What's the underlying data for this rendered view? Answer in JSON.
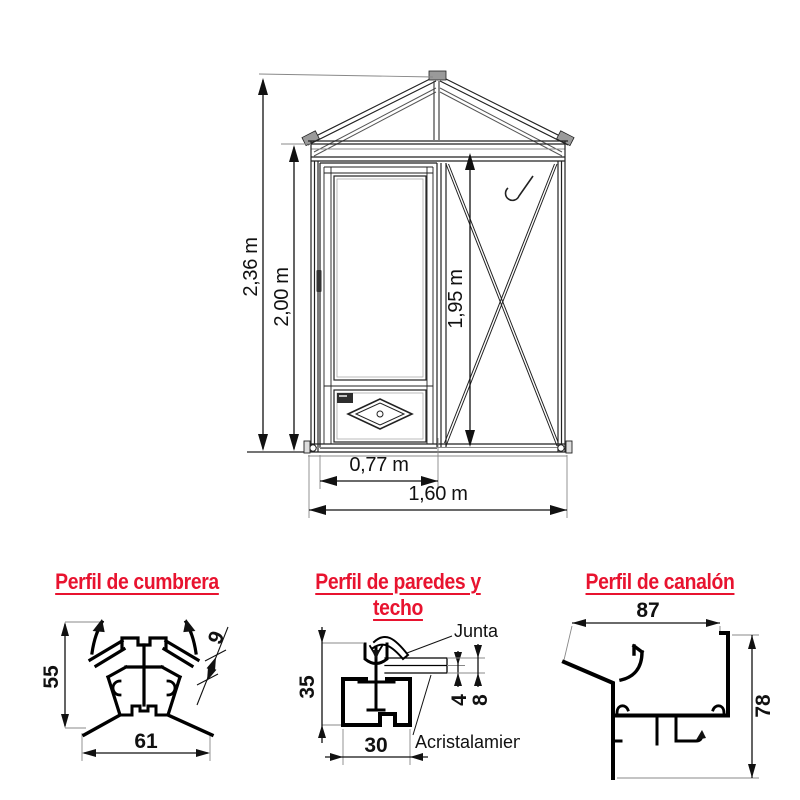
{
  "elevation": {
    "dim_total_height": "2,36 m",
    "dim_wall_height": "2,00 m",
    "dim_inner_height": "1,95 m",
    "dim_door_width": "0,77 m",
    "dim_total_width": "1,60 m"
  },
  "profiles": {
    "cumbrera": {
      "title": "Perfil de cumbrera",
      "dim_height": "55",
      "dim_width": "61",
      "dim_slot": "9"
    },
    "paredes": {
      "title": "Perfil de paredes y techo",
      "dim_height": "35",
      "dim_width": "30",
      "dim_glazing_single": "4",
      "dim_glazing_total": "8",
      "label_junta": "Junta",
      "label_acristalamiento": "Acristalamiento"
    },
    "canalon": {
      "title": "Perfil de canalón",
      "dim_width": "87",
      "dim_height": "78"
    }
  },
  "colors": {
    "accent_red": "#e8132f",
    "line_black": "#111111"
  }
}
